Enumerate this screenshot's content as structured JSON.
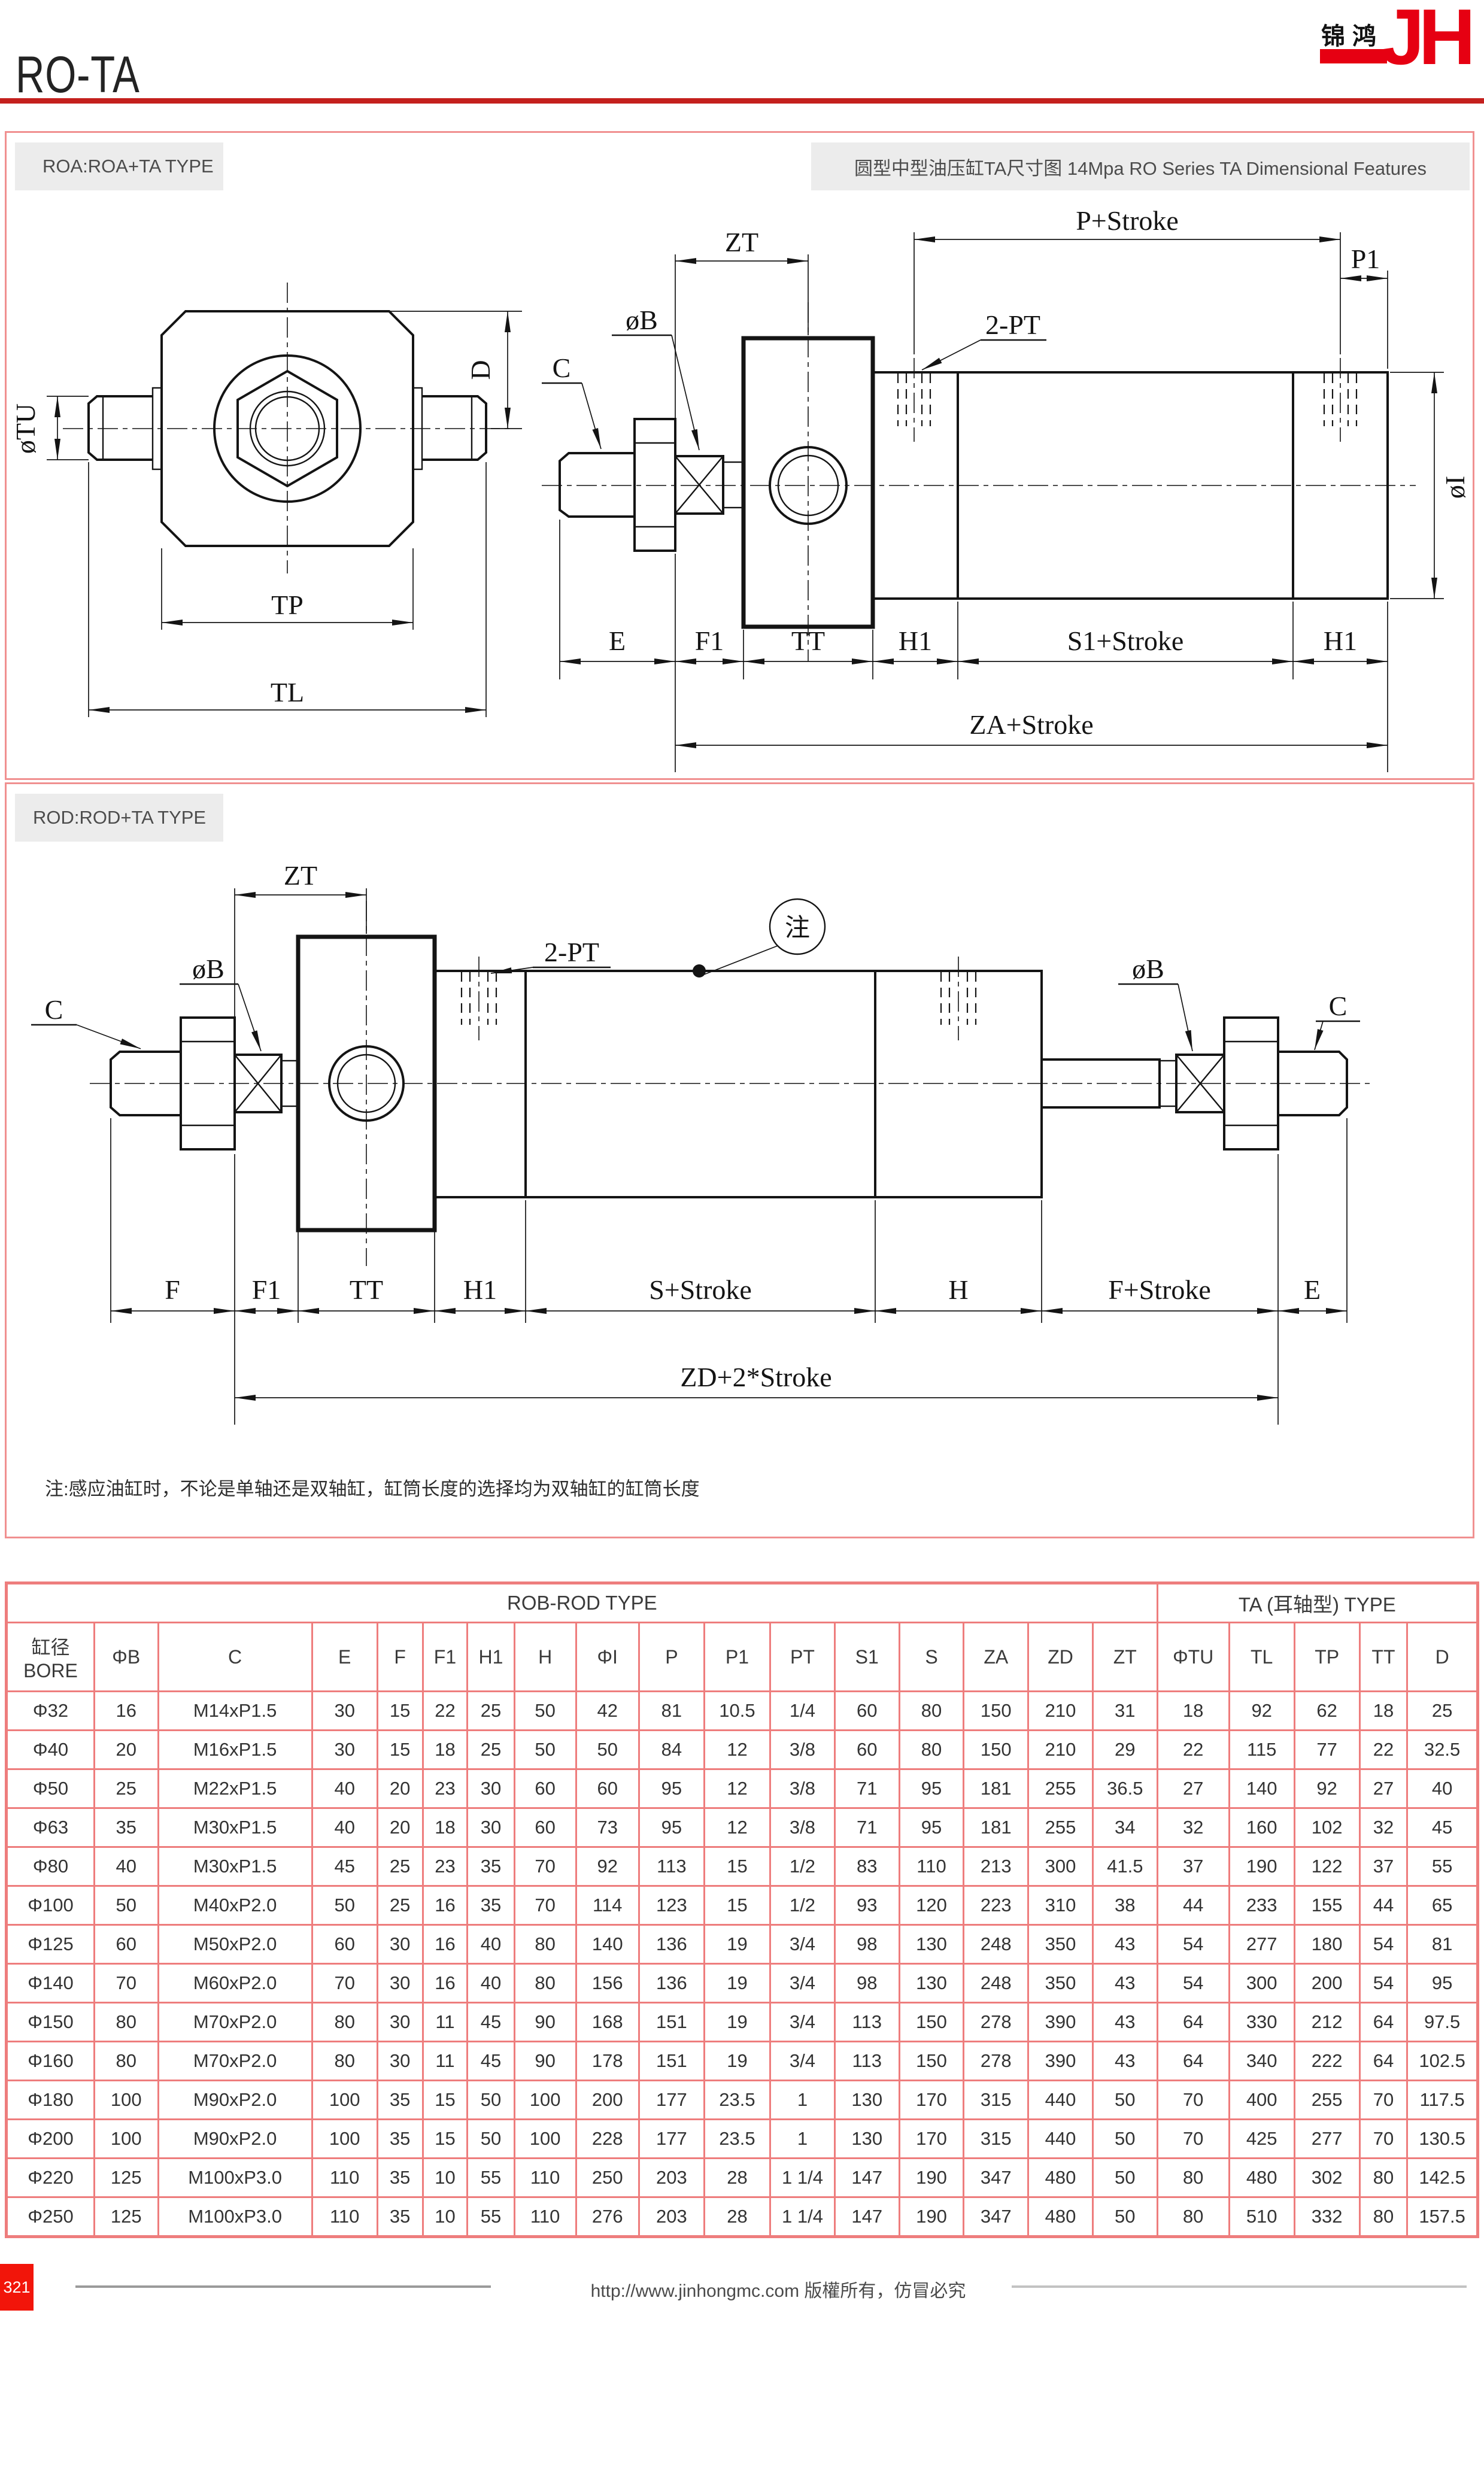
{
  "header": {
    "title": "RO-TA",
    "logo_cn": "锦鸿",
    "logo_en": "JH"
  },
  "sections": {
    "roa": {
      "label": "ROA:ROA+TA TYPE",
      "subtitle": "圆型中型油压缸TA尺寸图 14Mpa RO Series TA Dimensional Features",
      "labels": {
        "zt": "ZT",
        "p_stroke": "P+Stroke",
        "p1": "P1",
        "ob": "øB",
        "c": "C",
        "two_pt": "2-PT",
        "oi": "øI",
        "otu": "øTU",
        "d": "D",
        "tp": "TP",
        "tl": "TL",
        "e": "E",
        "f1": "F1",
        "tt": "TT",
        "h1_front": "H1",
        "s1_stroke": "S1+Stroke",
        "h1_rear": "H1",
        "za_stroke": "ZA+Stroke"
      }
    },
    "rod": {
      "label": "ROD:ROD+TA TYPE",
      "labels": {
        "zt": "ZT",
        "ob_left": "øB",
        "c_left": "C",
        "two_pt": "2-PT",
        "note_mark": "注",
        "ob_right": "øB",
        "c_right": "C",
        "f": "F",
        "f1": "F1",
        "tt": "TT",
        "h1": "H1",
        "s_stroke": "S+Stroke",
        "h": "H",
        "f_stroke": "F+Stroke",
        "e": "E",
        "zd_stroke": "ZD+2*Stroke"
      },
      "note": "注:感应油缸时，不论是单轴还是双轴缸，缸筒长度的选择均为双轴缸的缸筒长度"
    }
  },
  "table": {
    "group_headers": [
      "ROB-ROD TYPE",
      "TA (耳轴型) TYPE"
    ],
    "bore_header": {
      "zh": "缸径",
      "en": "BORE"
    },
    "columns": [
      "ΦB",
      "C",
      "E",
      "F",
      "F1",
      "H1",
      "H",
      "ΦI",
      "P",
      "P1",
      "PT",
      "S1",
      "S",
      "ZA",
      "ZD",
      "ZT",
      "ΦTU",
      "TL",
      "TP",
      "TT",
      "D"
    ],
    "rows": [
      [
        "Φ32",
        "16",
        "M14xP1.5",
        "30",
        "15",
        "22",
        "25",
        "50",
        "42",
        "81",
        "10.5",
        "1/4",
        "60",
        "80",
        "150",
        "210",
        "31",
        "18",
        "92",
        "62",
        "18",
        "25"
      ],
      [
        "Φ40",
        "20",
        "M16xP1.5",
        "30",
        "15",
        "18",
        "25",
        "50",
        "50",
        "84",
        "12",
        "3/8",
        "60",
        "80",
        "150",
        "210",
        "29",
        "22",
        "115",
        "77",
        "22",
        "32.5"
      ],
      [
        "Φ50",
        "25",
        "M22xP1.5",
        "40",
        "20",
        "23",
        "30",
        "60",
        "60",
        "95",
        "12",
        "3/8",
        "71",
        "95",
        "181",
        "255",
        "36.5",
        "27",
        "140",
        "92",
        "27",
        "40"
      ],
      [
        "Φ63",
        "35",
        "M30xP1.5",
        "40",
        "20",
        "18",
        "30",
        "60",
        "73",
        "95",
        "12",
        "3/8",
        "71",
        "95",
        "181",
        "255",
        "34",
        "32",
        "160",
        "102",
        "32",
        "45"
      ],
      [
        "Φ80",
        "40",
        "M30xP1.5",
        "45",
        "25",
        "23",
        "35",
        "70",
        "92",
        "113",
        "15",
        "1/2",
        "83",
        "110",
        "213",
        "300",
        "41.5",
        "37",
        "190",
        "122",
        "37",
        "55"
      ],
      [
        "Φ100",
        "50",
        "M40xP2.0",
        "50",
        "25",
        "16",
        "35",
        "70",
        "114",
        "123",
        "15",
        "1/2",
        "93",
        "120",
        "223",
        "310",
        "38",
        "44",
        "233",
        "155",
        "44",
        "65"
      ],
      [
        "Φ125",
        "60",
        "M50xP2.0",
        "60",
        "30",
        "16",
        "40",
        "80",
        "140",
        "136",
        "19",
        "3/4",
        "98",
        "130",
        "248",
        "350",
        "43",
        "54",
        "277",
        "180",
        "54",
        "81"
      ],
      [
        "Φ140",
        "70",
        "M60xP2.0",
        "70",
        "30",
        "16",
        "40",
        "80",
        "156",
        "136",
        "19",
        "3/4",
        "98",
        "130",
        "248",
        "350",
        "43",
        "54",
        "300",
        "200",
        "54",
        "95"
      ],
      [
        "Φ150",
        "80",
        "M70xP2.0",
        "80",
        "30",
        "11",
        "45",
        "90",
        "168",
        "151",
        "19",
        "3/4",
        "113",
        "150",
        "278",
        "390",
        "43",
        "64",
        "330",
        "212",
        "64",
        "97.5"
      ],
      [
        "Φ160",
        "80",
        "M70xP2.0",
        "80",
        "30",
        "11",
        "45",
        "90",
        "178",
        "151",
        "19",
        "3/4",
        "113",
        "150",
        "278",
        "390",
        "43",
        "64",
        "340",
        "222",
        "64",
        "102.5"
      ],
      [
        "Φ180",
        "100",
        "M90xP2.0",
        "100",
        "35",
        "15",
        "50",
        "100",
        "200",
        "177",
        "23.5",
        "1",
        "130",
        "170",
        "315",
        "440",
        "50",
        "70",
        "400",
        "255",
        "70",
        "117.5"
      ],
      [
        "Φ200",
        "100",
        "M90xP2.0",
        "100",
        "35",
        "15",
        "50",
        "100",
        "228",
        "177",
        "23.5",
        "1",
        "130",
        "170",
        "315",
        "440",
        "50",
        "70",
        "425",
        "277",
        "70",
        "130.5"
      ],
      [
        "Φ220",
        "125",
        "M100xP3.0",
        "110",
        "35",
        "10",
        "55",
        "110",
        "250",
        "203",
        "28",
        "1 1/4",
        "147",
        "190",
        "347",
        "480",
        "50",
        "80",
        "480",
        "302",
        "80",
        "142.5"
      ],
      [
        "Φ250",
        "125",
        "M100xP3.0",
        "110",
        "35",
        "10",
        "55",
        "110",
        "276",
        "203",
        "28",
        "1 1/4",
        "147",
        "190",
        "347",
        "480",
        "50",
        "80",
        "510",
        "332",
        "80",
        "157.5"
      ]
    ]
  },
  "footer": {
    "page_number": "321",
    "copyright": "http://www.jinhongmc.com 版權所有，仿冒必究"
  },
  "colors": {
    "accent_red": "#c4201d",
    "logo_red": "#e60012",
    "table_border": "#ee7d7d",
    "panel_border": "#f09090",
    "badge_red": "#f2150a"
  }
}
